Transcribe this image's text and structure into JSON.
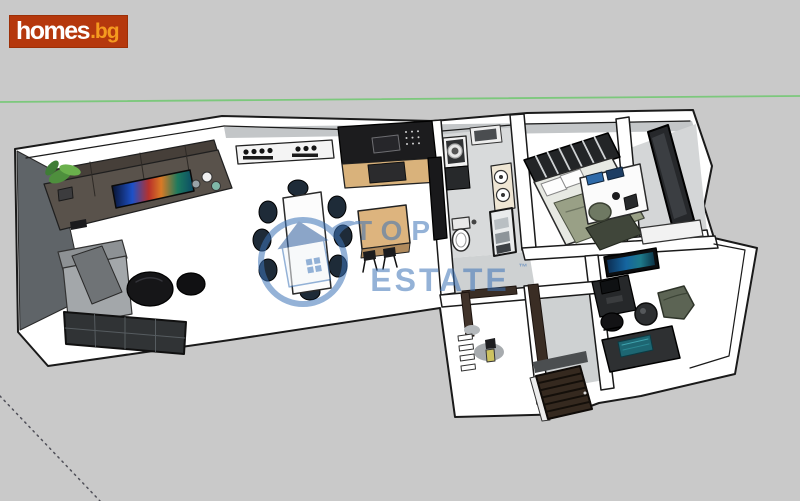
{
  "page": {
    "width_px": 800,
    "height_px": 501,
    "background_color": "#c9c9c9"
  },
  "site_logo": {
    "name": "homes.bg",
    "text_primary": "homes",
    "text_suffix": ".bg",
    "background_color": "#b5380d",
    "primary_color": "#ffffff",
    "suffix_color": "#f59a1f"
  },
  "watermark": {
    "brand_line1": "TOP",
    "brand_line2": "ESTATE",
    "trademark_symbol": "™",
    "color": "#3d74b8",
    "opacity": 0.55,
    "logo": "house-in-ring-icon"
  },
  "sketchup_axes": {
    "green_axis_color": "#7cc87c",
    "dashed_axis_color": "#4f4f58"
  },
  "floor_plan": {
    "style": "3D SketchUp-style apartment floor plan, oblique top-down view",
    "wall_color": "#ffffff",
    "outline_color": "#1a1a1a",
    "wood_accent_color": "#d9b27b",
    "rooms": [
      {
        "name": "living-room",
        "furniture": [
          "tv-wall-unit",
          "flat-screen-tv",
          "potted-plant",
          "wall-shelf-with-bottles",
          "sofa-with-blanket",
          "round-poufs",
          "window"
        ]
      },
      {
        "name": "kitchen",
        "furniture": [
          "black-cabinets",
          "wood-countertop",
          "wall-oven",
          "microwave",
          "kitchen-island",
          "bar-stools"
        ]
      },
      {
        "name": "dining-area",
        "furniture": [
          "dining-table",
          "chairs"
        ]
      },
      {
        "name": "bathroom",
        "furniture": [
          "wall-cabinet",
          "washing-machine",
          "double-sink",
          "towel-shelf",
          "toilet"
        ]
      },
      {
        "name": "hallway",
        "furniture": [
          "door-frames",
          "ladder-shelf",
          "staircase",
          "entry-door"
        ]
      },
      {
        "name": "wc",
        "furniture": [
          "shelf",
          "toiletries"
        ]
      },
      {
        "name": "bedroom",
        "furniture": [
          "double-bed",
          "slatted-headboard",
          "pillows",
          "olive-blanket",
          "desk-with-laptops",
          "chair"
        ]
      },
      {
        "name": "office",
        "furniture": [
          "wall-tv",
          "desk-with-monitor",
          "office-chair",
          "armchair",
          "round-side-table",
          "media-cabinet"
        ]
      },
      {
        "name": "closet-room",
        "furniture": [
          "wardrobe-panel",
          "shelf-with-items"
        ]
      }
    ]
  }
}
